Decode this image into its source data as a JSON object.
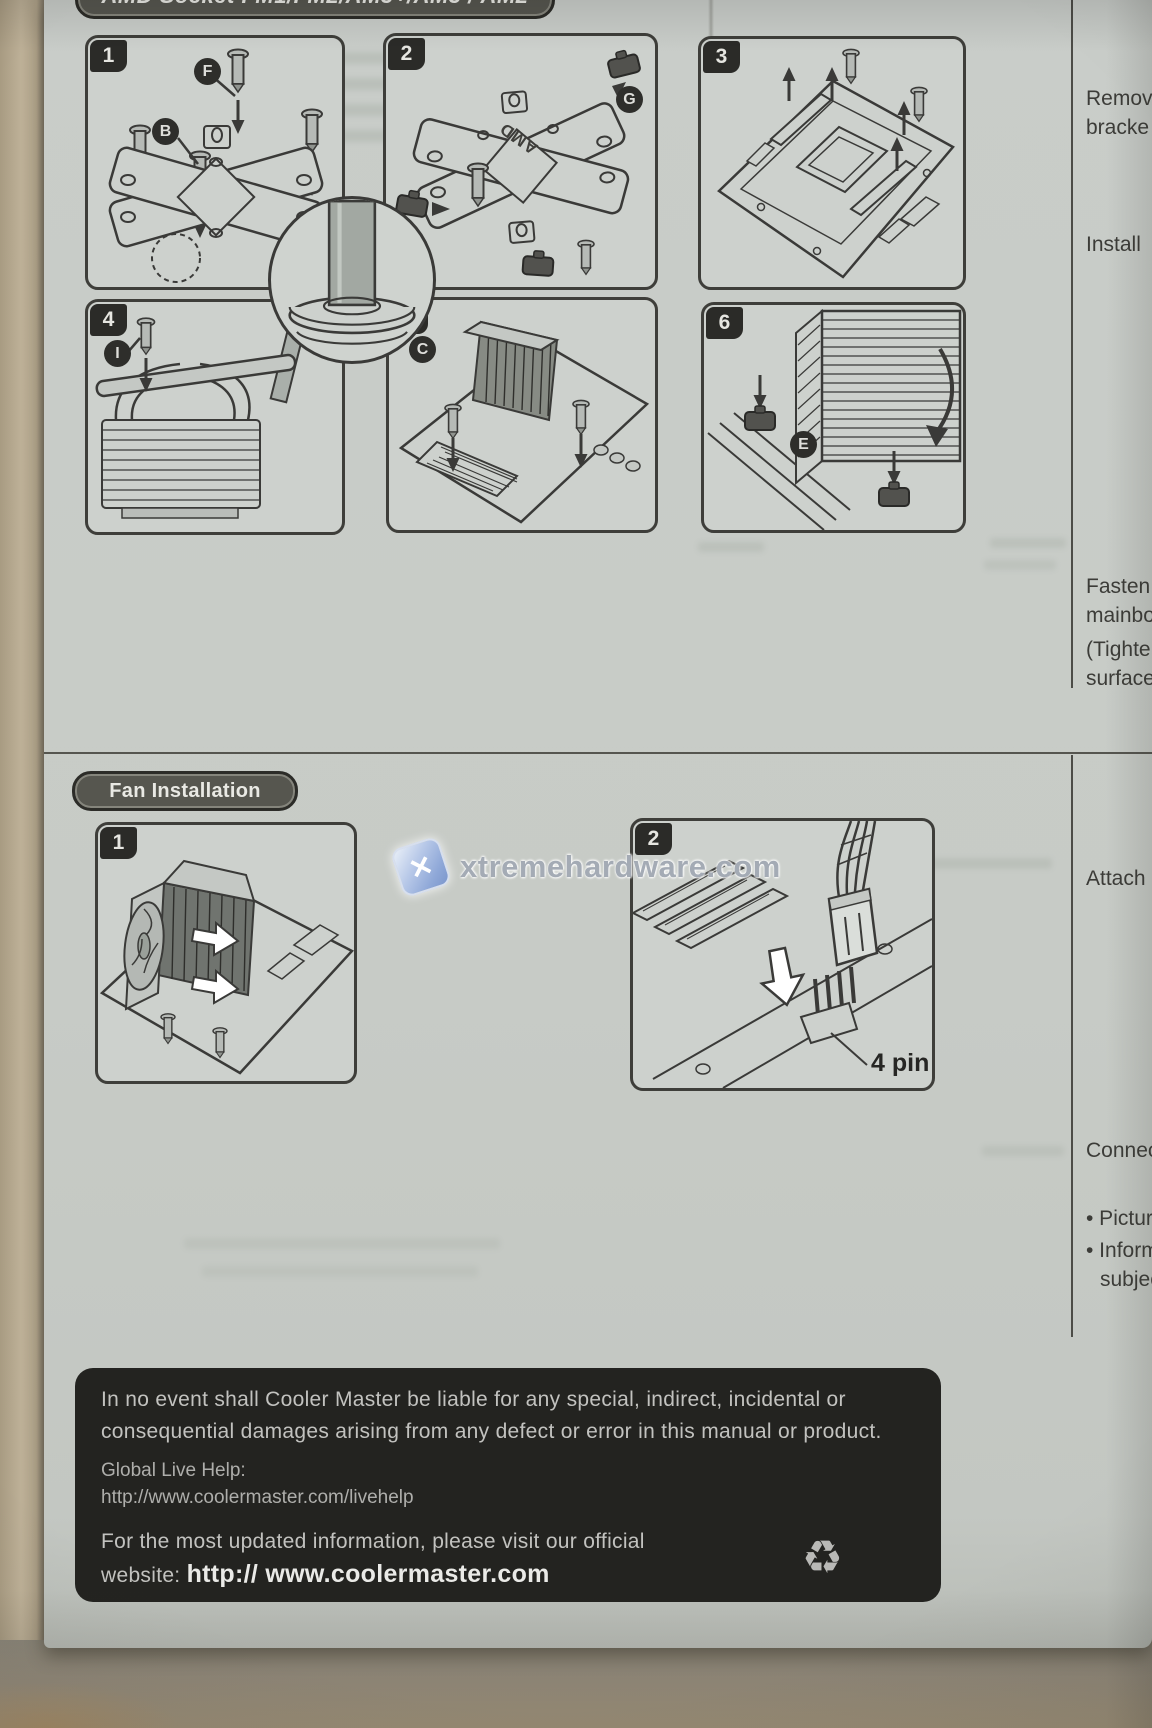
{
  "header": {
    "socket_title": "AMD Socket FM1/FM2/AM3+/AM3 / AM2"
  },
  "sections": {
    "fan_installation": "Fan Installation"
  },
  "steps": {
    "s1": {
      "number": "1",
      "labels": {
        "f": "F",
        "b": "B"
      }
    },
    "s2": {
      "number": "2",
      "labels": {
        "g": "G"
      },
      "bracket_text": "AMD"
    },
    "s3": {
      "number": "3"
    },
    "s4": {
      "number": "4",
      "labels": {
        "i": "I"
      }
    },
    "s5": {
      "number": "5",
      "labels": {
        "c": "C"
      }
    },
    "s6": {
      "number": "6",
      "labels": {
        "e": "E"
      }
    }
  },
  "fan_steps": {
    "f1": {
      "number": "1"
    },
    "f2": {
      "number": "2",
      "connector_label": "4 pin"
    }
  },
  "margin_notes": {
    "remove_line1": "Remov",
    "remove_line2": "bracke",
    "install": "Install",
    "fasten_line1": "Fasten t",
    "fasten_line2": "mainboa",
    "fasten_line3": "(Tighte",
    "fasten_line4": "surface",
    "attach": "Attach",
    "connect": "Connec",
    "bullet_picture": "• Picture",
    "bullet_inform_line1": "• Inform",
    "bullet_inform_line2": "subjec"
  },
  "watermark": {
    "text": "xtremehardware.com",
    "icon_glyph": "✕"
  },
  "footer": {
    "disclaimer_line1": "In no event shall Cooler Master be liable for any special, indirect, incidental or",
    "disclaimer_line2": "consequential damages arising from any defect or error in this manual or product.",
    "help_label": "Global Live Help:",
    "help_url": "http://www.coolermaster.com/livehelp",
    "updated_line": "For the most updated information, please visit our official",
    "website_prefix": "website:",
    "website_url": "http:// www.coolermaster.com",
    "recycle_glyph": "♻"
  },
  "colors": {
    "paper": "#c7cbc6",
    "ink": "#3a3a38",
    "footer_bg": "#232320",
    "watermark_blue": "#8fa8d8",
    "table_tan": "#b3a68b"
  }
}
